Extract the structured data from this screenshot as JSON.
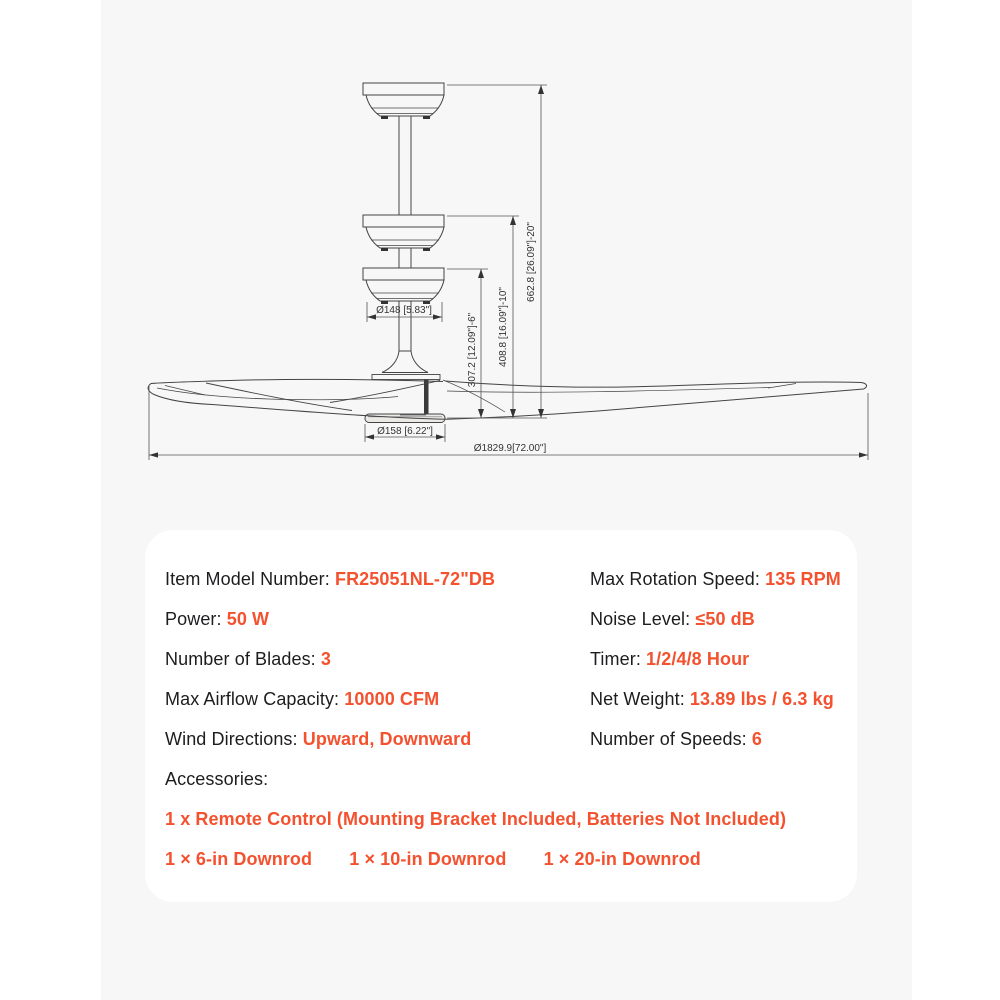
{
  "colors": {
    "accent": "#f4512f",
    "text": "#1d1d1f",
    "panel_bg": "#f7f7f8",
    "card_bg": "#ffffff",
    "drawing_line": "#444444"
  },
  "diagram": {
    "dim_canopy_diameter": "Ø148 [5.83\"]",
    "dim_motor_diameter": "Ø158 [6.22\"]",
    "dim_blade_sweep": "Ø1829.9[72.00\"]",
    "dim_height_6in": "307.2 [12.09\"]-6\"",
    "dim_height_10in": "408.8 [16.09\"]-10\"",
    "dim_height_20in": "662.8 [26.09\"]-20\""
  },
  "specs": {
    "left": [
      {
        "label": "Item Model Number: ",
        "value": "FR25051NL-72\"DB"
      },
      {
        "label": "Power: ",
        "value": "50 W"
      },
      {
        "label": "Number of Blades: ",
        "value": "3"
      },
      {
        "label": "Max Airflow Capacity: ",
        "value": "10000 CFM"
      },
      {
        "label": "Wind Directions: ",
        "value": "Upward, Downward"
      },
      {
        "label": "Accessories:",
        "value": ""
      }
    ],
    "right": [
      {
        "label": "Max Rotation Speed: ",
        "value": "135 RPM"
      },
      {
        "label": "Noise Level: ",
        "value": "≤50 dB"
      },
      {
        "label": "Timer: ",
        "value": "1/2/4/8 Hour"
      },
      {
        "label": "Net Weight: ",
        "value": "13.89 lbs / 6.3 kg"
      },
      {
        "label": "Number of Speeds: ",
        "value": "6"
      }
    ],
    "accessories": [
      "1 x Remote Control (Mounting Bracket Included, Batteries Not Included)",
      "1 × 6-in Downrod",
      "1 × 10-in Downrod",
      "1 × 20-in Downrod"
    ]
  }
}
